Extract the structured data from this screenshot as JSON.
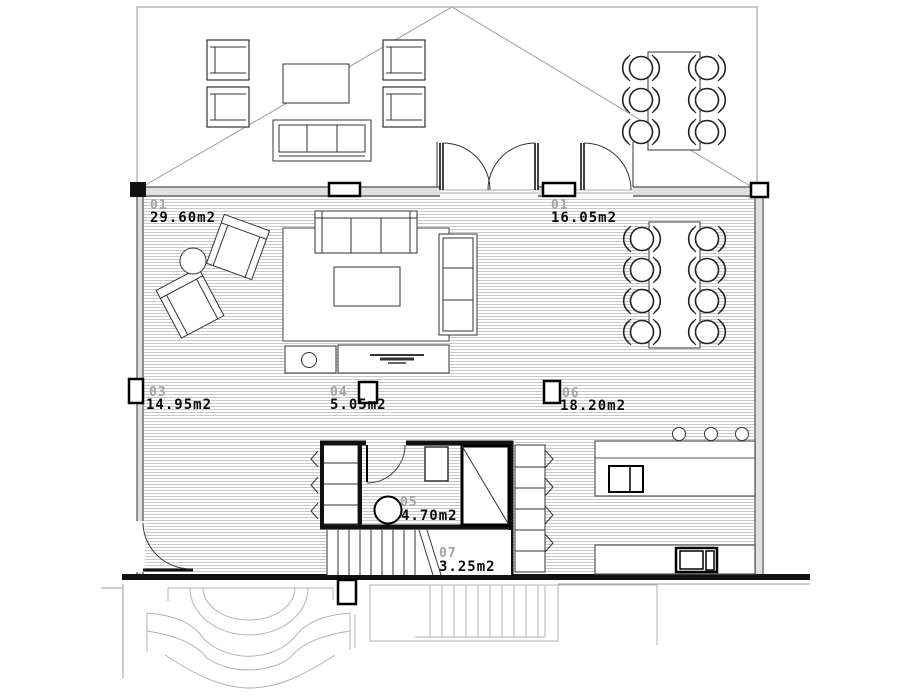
{
  "plan": {
    "kind": "architectural floor plan",
    "unit_suffix": "m2",
    "rooms": [
      {
        "number": "01",
        "area": "29.60m2"
      },
      {
        "number": "01",
        "area": "16.05m2"
      },
      {
        "number": "03",
        "area": "14.95m2"
      },
      {
        "number": "04",
        "area": "5.05m2"
      },
      {
        "number": "06",
        "area": "18.20m2"
      },
      {
        "number": "05",
        "area": "4.70m2"
      },
      {
        "number": "07",
        "area": "3.25m2"
      }
    ],
    "palette": {
      "background": "#ffffff",
      "wall_dark": "#111111",
      "wall_fill": "#e0e0e0",
      "floor_hatch": "#c9c9c9",
      "exterior_gray": "#9a9a9a",
      "room_number_gray": "#a3a3a3",
      "room_area_black": "#0a0a0a"
    }
  }
}
